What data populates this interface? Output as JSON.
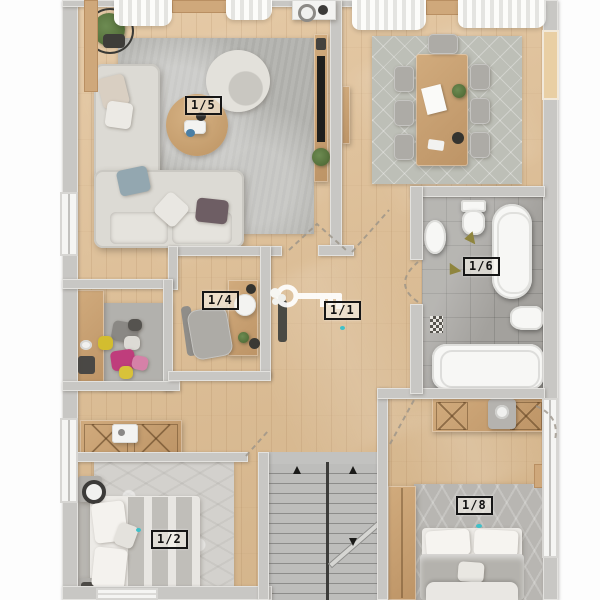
{
  "title": "Apartment floor plan – 3D top view",
  "rooms": [
    {
      "id": "living-room",
      "label": "1/5"
    },
    {
      "id": "study",
      "label": "1/4"
    },
    {
      "id": "hallway",
      "label": "1/1"
    },
    {
      "id": "bathroom",
      "label": "1/6"
    },
    {
      "id": "bedroom-main",
      "label": "1/2"
    },
    {
      "id": "bedroom-second",
      "label": "1/8"
    }
  ],
  "colors": {
    "wood_floor": "#debf9b",
    "wall_gray": "#c8c7c4",
    "bath_tile": "#a3a19d",
    "rug_gray": "#b6b6b2",
    "fixture_white": "#f7f7f5",
    "accent_magenta": "#bf3d7c",
    "accent_yellow": "#d3bd2f",
    "key_overlay_white": "#ffffff"
  }
}
